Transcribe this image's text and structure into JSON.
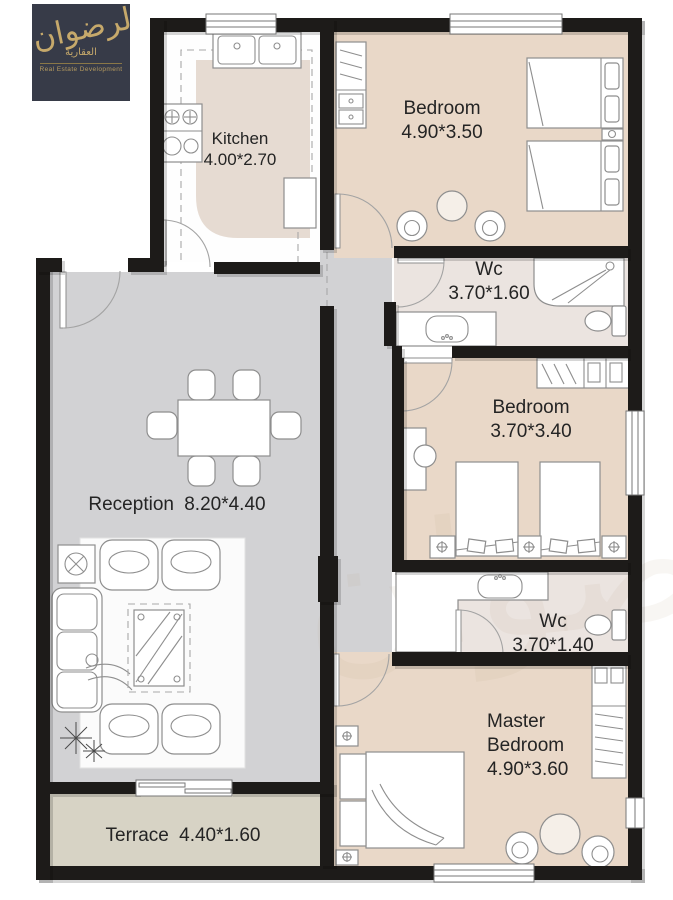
{
  "logo": {
    "brand_arabic": "الرضوان",
    "sub_arabic": "العقارية",
    "subtitle": "Real Estate Development"
  },
  "rooms": {
    "kitchen": {
      "name": "Kitchen",
      "dims": "4.00*2.70"
    },
    "bedroom1": {
      "name": "Bedroom",
      "dims": "4.90*3.50"
    },
    "wc1": {
      "name": "Wc",
      "dims": "3.70*1.60"
    },
    "bedroom2": {
      "name": "Bedroom",
      "dims": "3.70*3.40"
    },
    "reception": {
      "name": "Reception",
      "dims": "8.20*4.40"
    },
    "wc2": {
      "name": "Wc",
      "dims": "3.70*1.40"
    },
    "master": {
      "name_line1": "Master",
      "name_line2": "Bedroom",
      "dims": "4.90*3.60"
    },
    "terrace": {
      "name": "Terrace",
      "dims": "4.40*1.60"
    }
  },
  "colors": {
    "wall": "#1d1b19",
    "bedroom": "#e9d8c8",
    "reception": "#d2d2d4",
    "wc": "#ebe4e0",
    "kitchen": "#fefefe",
    "island": "#e6dbd2",
    "terrace": "#d7d3c5",
    "furn": "#8e8e8e",
    "ink": "#242424",
    "logo-bg": "#373b48",
    "gold": "#c6a96b"
  }
}
